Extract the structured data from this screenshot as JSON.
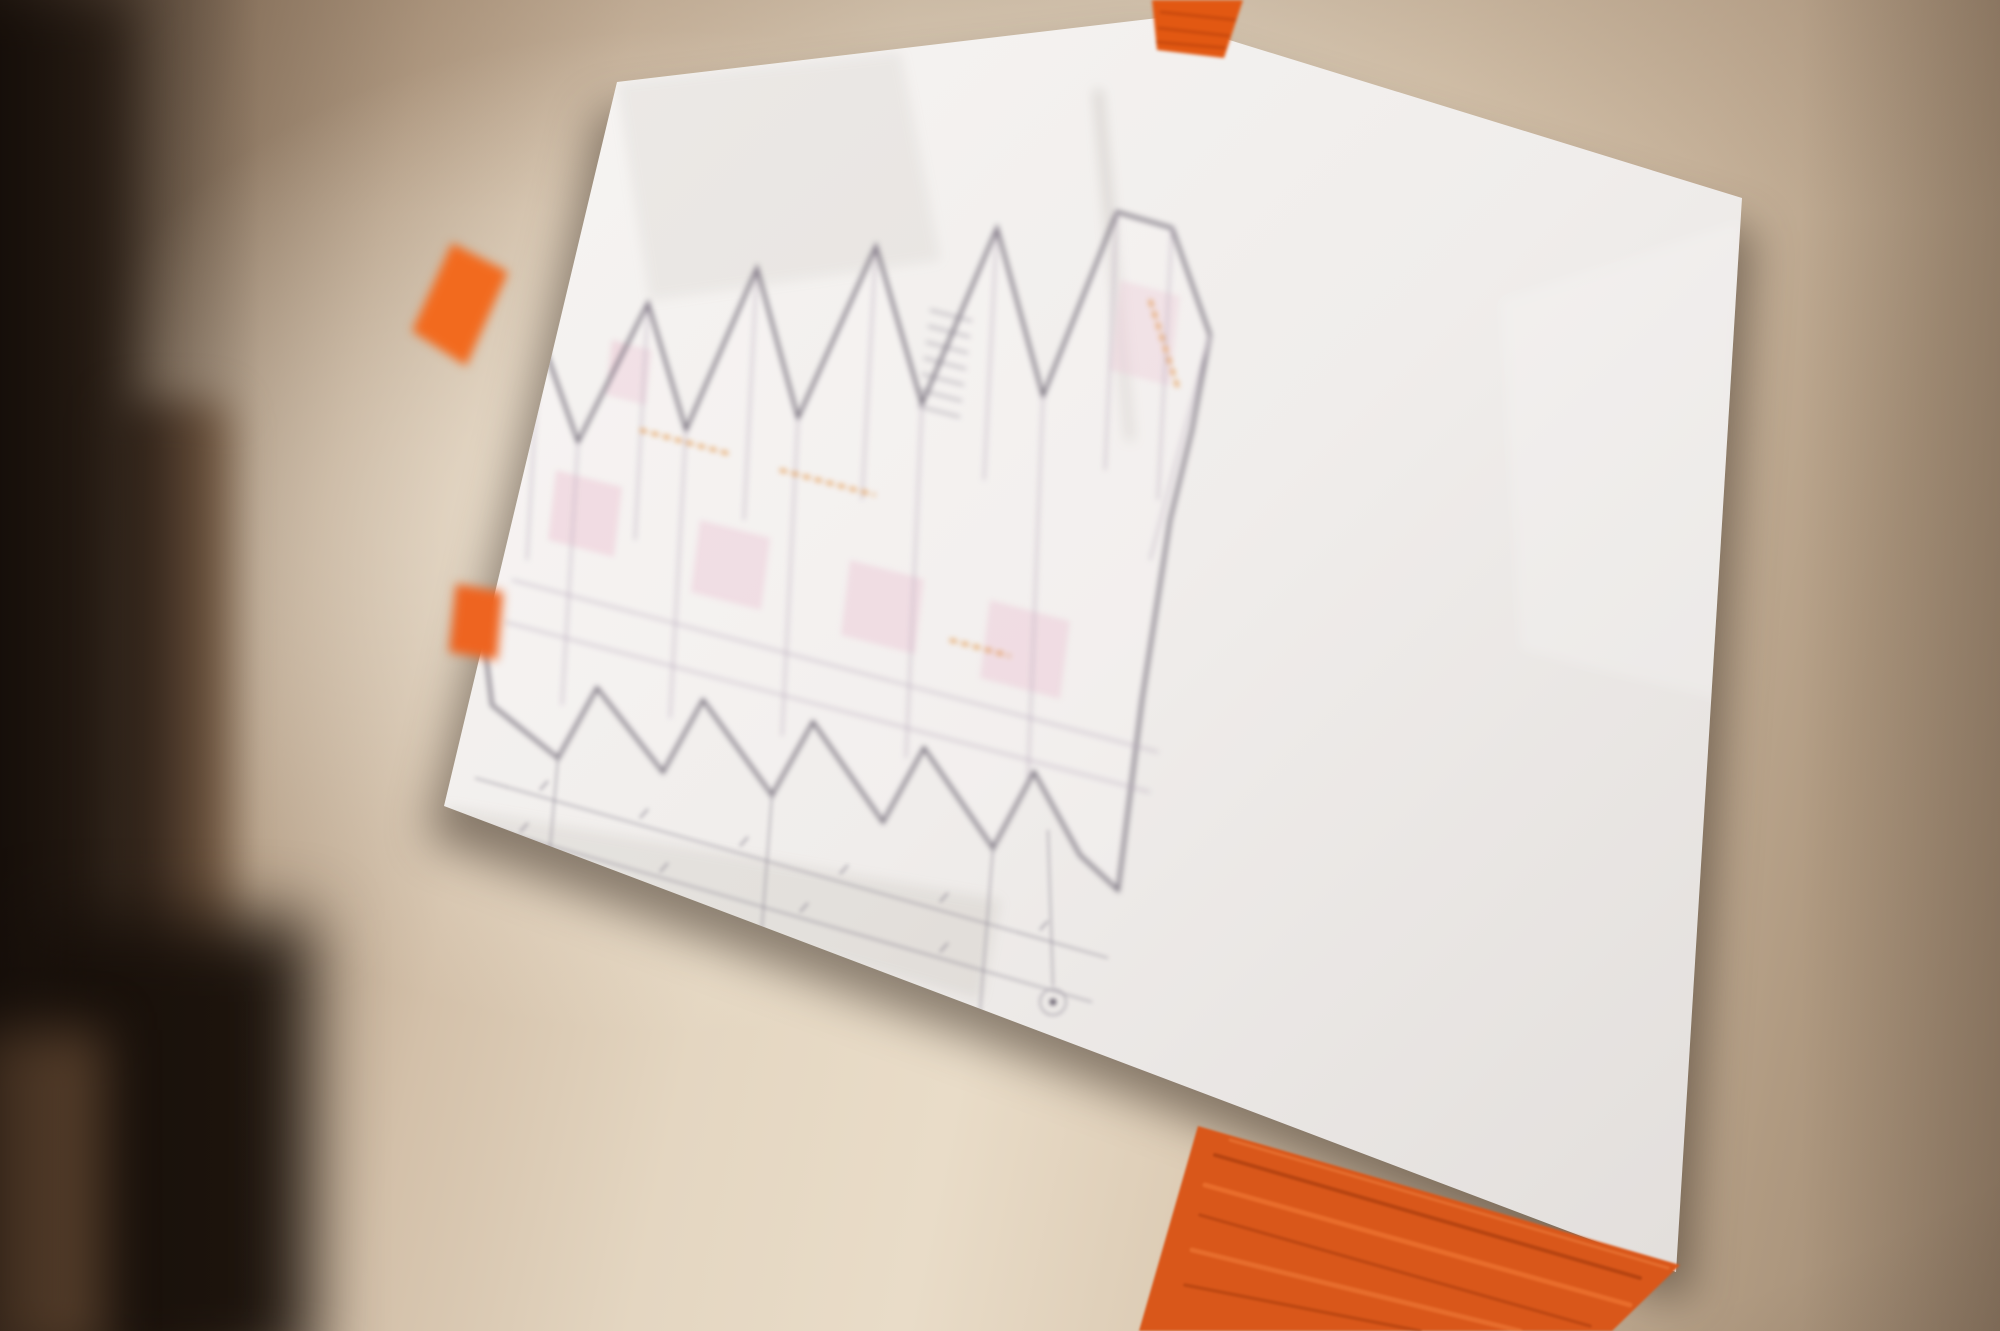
{
  "scene": {
    "description": "Photograph of an architectural floor-plan drawing sheet taped to a hallway wall with pieces of orange painter's tape; left side of frame shows a blurred dark doorway"
  },
  "colors": {
    "tape_orange": "#e25812",
    "murator_red": "#e2443a",
    "paper": "#f2efec",
    "wall": "#d8c8b2",
    "plan_pink": "#e9bccd",
    "plan_orange": "#e0862c"
  },
  "legend": {
    "title": "LEGENDA:",
    "items": [
      {
        "swatch": "hatched",
        "label": "- elementy istniejące"
      },
      {
        "swatch": "orange-dashed",
        "label": "- elementy do usunięcia"
      },
      {
        "swatch": "pink-filled",
        "label": "- elementy projektowane"
      }
    ],
    "note": "UWAGA: ściany z luksferów do wyburzenia"
  },
  "notes": {
    "title": "UWAGI:",
    "items": [
      "1. WSZYSTKIE WYMIARY ZWERYFIKOWAĆ W NATURZE",
      "2. DOPUSZCZA SIĘ ZMIANĘ WYMIARÓW, ELEMENTÓW WYPOSAŻENIA, DŹWIGÓW ITP., POD WARUNKIEM SPEŁNIENIA WARUNKÓW TECHNICZNYCH OKREŚLONYCH OBOWIĄZUJĄCYMI PRZEPISAMI.",
      "3. RYSUNEK ROZPATRYWAĆ ŁĄCZNIE Z PROJEKTAMI BRANŻOWYMI",
      "4. REALIZACJĘ PROWADZIĆ W OPARCIU O KOMPLETNĄ DOKUMENTACJĘ PROJEKTOWĄ WYKONAWCZĄ, W TYM PROJEKTY BRANŻOWE.",
      "5. WSZELKIE MATERIAŁY, WYPOSAŻENIE I URZĄDZENIA UŻYTE W TRAKCIE REALIZACJI INWESTYCJI MUSZĄ POSIADAĆ STOSOWNE ATESTY I DOPUSZCZENIA DO STOSOWANIA W BUDOWNICTWIE.",
      "6. WSZELKIE MATERIAŁY UŻYTE DO WYKOŃCZENIA WNĘTRZ POWINNY BYĆ TAKIE, KTÓRYCH PRODUKTY ROZKŁADU TERMICZNEGO NIE SĄ BARDZO TOKSYCZNE I SILNIE DYMIĄCE.",
      "7. WSZYSTKIE WYKŁADZINY PODŁOGOWE, OKŁADZINY ŚCIENNE ORAZ STAŁE ELEMENTY WYKOŃCZENIA WNĘTRZ POWINNY BYĆ CO NAJMNIEJ „TRUDNO ZAPALNE”.",
      "8. PRZED PRZYSTĄPIENIEM DO WYCENY NALEŻY DOKONAĆ WIZJI LOKALNEJ."
    ]
  },
  "logo": {
    "murator": "murator",
    "ibs": "IBS"
  },
  "title_block": {
    "inwestor_label": "INWESTOR:",
    "inwestor_name": "Zjednoczone Przedsiębiorstwa Rozrywkowe S.A",
    "inwestor_address": "ul. Senatorska 13/15, 00-075 Warszawa",
    "generalny_label": "GENERALNY PROJEKTANT:",
    "firm_name": "Murator IBS Sp. z o.o.",
    "firm_addr1": "Julinek 1, 05-084 Leszno",
    "firm_addr2": "Biuro: ul. Jubilerska 10, 04-190 Warszawa",
    "projekt_label": "PROJEKT:",
    "projekt_value": "Remont apartamentów przy ul. Dęblińskiej 4",
    "adres_label": "ADRES INWESTYCJI:",
    "adres_value": "Warszawa, Gmina Praga-Południe, działka nr ew. 23/1, obr. 0529",
    "faza_label": "FAZA:",
    "faza_value": "PROJEKT WYKONAWCZY",
    "rysunek_label": "RYSUNEK:",
    "rysunek_value": "Schemat elementów projektowanych i do wyburzenia K4.",
    "branza_label": "BRANŻA:",
    "branza_value": "ARCHITEKTURA",
    "skala_label": "SKALA:",
    "projektant_label": "PROJEKTANT:",
    "projektant_name": "mgr inż. arch. Maciej Ząbik",
    "projektant_upr1": "upr. nr MA/042/12 w specjalności",
    "projektant_upr2": "architektonicznej bez ograniczeń",
    "podpis_label": "PODPIS:",
    "zespol_label": "ZESPÓŁ PROJEKTOWY:",
    "zespol_names": [
      "mgr inż. arch. Katarzyna Pawelek",
      "mgr inż. arch. Iryna Shaplatka"
    ]
  }
}
